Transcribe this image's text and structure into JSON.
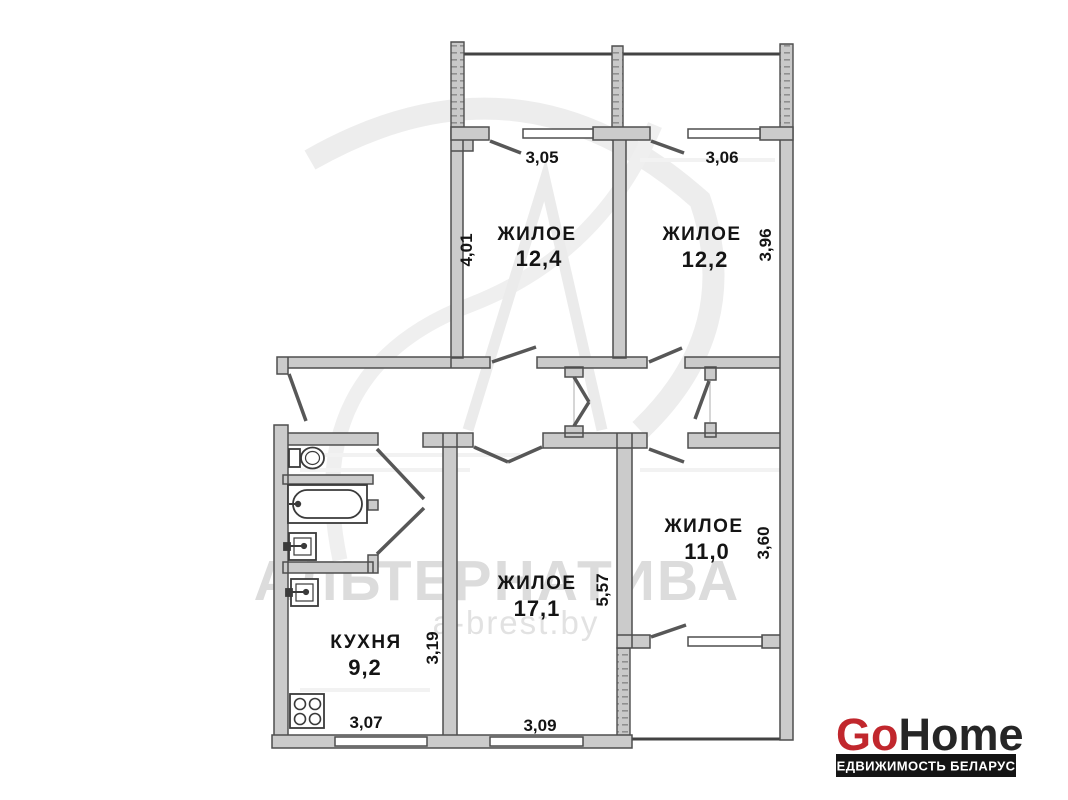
{
  "plan": {
    "rooms": [
      {
        "name": "ЖИЛОЕ",
        "area": "12,4"
      },
      {
        "name": "ЖИЛОЕ",
        "area": "12,2"
      },
      {
        "name": "ЖИЛОЕ",
        "area": "17,1"
      },
      {
        "name": "ЖИЛОЕ",
        "area": "11,0"
      },
      {
        "name": "КУХНЯ",
        "area": "9,2"
      }
    ],
    "dims": {
      "w_room1": "3,05",
      "w_room2": "3,06",
      "h_room1": "4,01",
      "h_room2": "3,96",
      "h_kitchen": "3,19",
      "h_room3": "5,57",
      "h_room4": "3,60",
      "w_kitchen": "3,07",
      "w_room3": "3,09"
    },
    "fixtures": [
      "toilet",
      "bathtub",
      "sink",
      "sink",
      "stove"
    ]
  },
  "watermark": {
    "agency": "АЛЬТЕРНАТИВА",
    "site": "a-brest.by"
  },
  "logo": {
    "part1": "Go",
    "part2": "Home",
    "tagline": "НЕДВИЖИМОСТЬ БЕЛАРУСИ",
    "accent_color": "#c1272d",
    "dark_color": "#262626",
    "bar_bg": "#141414"
  },
  "colors": {
    "background": "#ffffff",
    "wall_fill": "#cbcbcb",
    "wall_stroke": "#4e4e4e",
    "label_text": "#141414",
    "watermark_gray": "#dcdcdc"
  }
}
